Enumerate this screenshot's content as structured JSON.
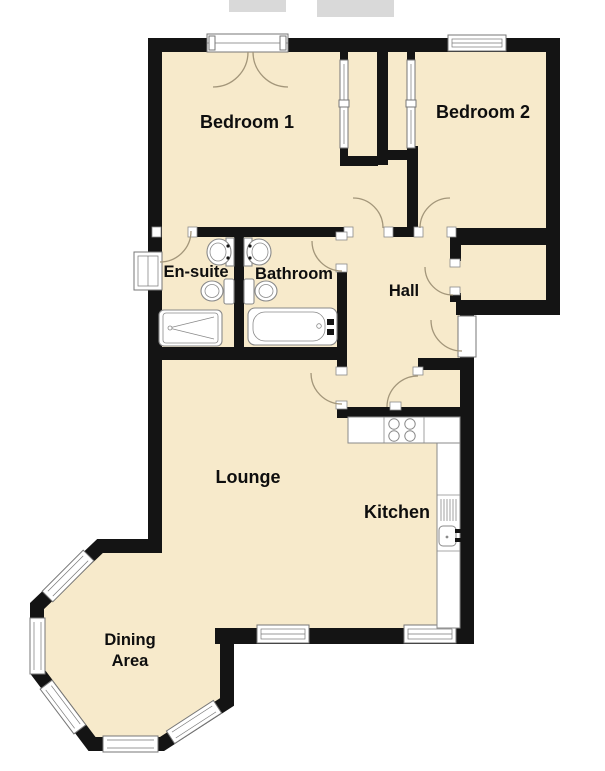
{
  "plan_type": "apartment-floor-plan",
  "rooms": [
    {
      "id": "bedroom-1",
      "label": "Bedroom 1"
    },
    {
      "id": "bedroom-2",
      "label": "Bedroom 2"
    },
    {
      "id": "en-suite",
      "label": "En-suite"
    },
    {
      "id": "bathroom",
      "label": "Bathroom"
    },
    {
      "id": "hall",
      "label": "Hall"
    },
    {
      "id": "lounge",
      "label": "Lounge"
    },
    {
      "id": "kitchen",
      "label": "Kitchen"
    },
    {
      "id": "dining-area",
      "label": "Dining Area",
      "line1": "Dining",
      "line2": "Area"
    }
  ],
  "fixtures": [
    "shower-tray",
    "bathtub",
    "toilet-ensuite",
    "toilet-bathroom",
    "wash-basin-ensuite",
    "wash-basin-bathroom",
    "cooker-hob",
    "kitchen-sink-drainer",
    "kitchen-counter",
    "wardrobe-bedroom-1",
    "wardrobe-bedroom-2"
  ],
  "openings": [
    "french-window-bedroom-1",
    "window-bedroom-2",
    "window-en-suite",
    "window-lounge",
    "window-kitchen",
    "bay-windows-dining-area",
    "front-entrance-door",
    "door-bedroom-1",
    "door-bedroom-2",
    "door-en-suite",
    "door-bathroom",
    "door-lounge",
    "door-hall-cupboard",
    "door-storage-cupboard"
  ],
  "colors": {
    "floor": "#F7EACB",
    "wall": "#141414",
    "door_arc": "#A3967A",
    "fixture_outline": "#8a8a8a",
    "window_frame": "#777777",
    "watermark": "#d9d9d9"
  }
}
